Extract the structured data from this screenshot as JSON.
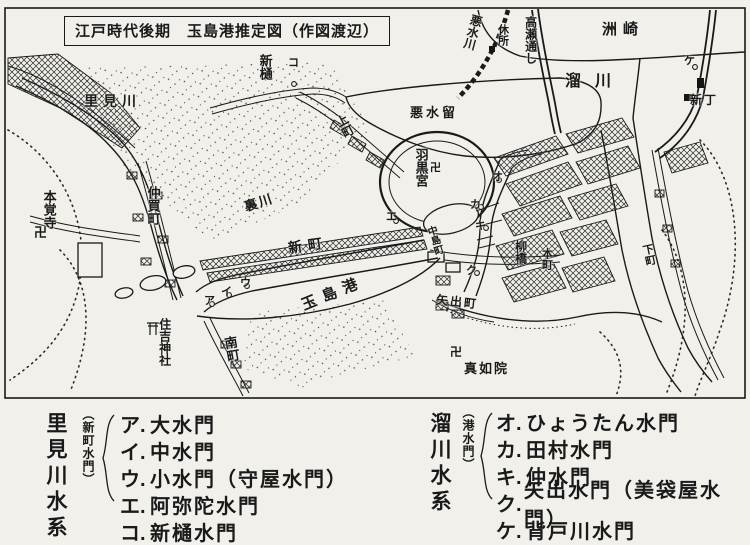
{
  "title": "江戸時代後期　玉島港推定図（作図渡辺）",
  "map": {
    "temple_symbol": "卍",
    "labels": [
      {
        "id": "suzaki",
        "text": "洲崎"
      },
      {
        "id": "tamarigawa",
        "text": "溜川"
      },
      {
        "id": "akusuigawa",
        "text": "悪水川"
      },
      {
        "id": "kyusho",
        "text": "休所"
      },
      {
        "id": "takasedoshi",
        "text": "高瀬通し"
      },
      {
        "id": "shincho",
        "text": "新丁"
      },
      {
        "id": "shinhi",
        "text": "新樋"
      },
      {
        "id": "akusuidome",
        "text": "悪水留"
      },
      {
        "id": "uwamachi",
        "text": "上町"
      },
      {
        "id": "satomigawa",
        "text": "里見川"
      },
      {
        "id": "hagurogu",
        "text": "羽黒宮"
      },
      {
        "id": "nakagaicho",
        "text": "仲買町"
      },
      {
        "id": "honkakuji",
        "text": "本覚寺"
      },
      {
        "id": "uragawa",
        "text": "裏川"
      },
      {
        "id": "shinmachi",
        "text": "新町"
      },
      {
        "id": "tamashimako",
        "text": "玉島港"
      },
      {
        "id": "sumiyoshi",
        "text": "住吉神社"
      },
      {
        "id": "minamimachi",
        "text": "南町"
      },
      {
        "id": "nakashimacho",
        "text": "中島町"
      },
      {
        "id": "yanagibashi",
        "text": "柳橋"
      },
      {
        "id": "honmachi",
        "text": "本町"
      },
      {
        "id": "yadecho",
        "text": "矢出町"
      },
      {
        "id": "shinnyoin",
        "text": "真如院"
      },
      {
        "id": "shimomachi",
        "text": "下町"
      }
    ],
    "markers": [
      {
        "key": "ア"
      },
      {
        "key": "イ"
      },
      {
        "key": "ウ"
      },
      {
        "key": "エ"
      },
      {
        "key": "オ"
      },
      {
        "key": "カ"
      },
      {
        "key": "キ"
      },
      {
        "key": "ク"
      },
      {
        "key": "ケ"
      },
      {
        "key": "コ"
      }
    ]
  },
  "legend": {
    "left": {
      "system": "里見川水系",
      "note": "（新町水門）",
      "items": [
        {
          "key": "ア.",
          "name": "大水門"
        },
        {
          "key": "イ.",
          "name": "中水門"
        },
        {
          "key": "ウ.",
          "name": "小水門（守屋水門）"
        },
        {
          "key": "エ.",
          "name": "阿弥陀水門"
        },
        {
          "key": "コ.",
          "name": "新樋水門"
        }
      ]
    },
    "right": {
      "system": "溜川水系",
      "note": "（港水門）",
      "items": [
        {
          "key": "オ.",
          "name": "ひょうたん水門"
        },
        {
          "key": "カ.",
          "name": "田村水門"
        },
        {
          "key": "キ.",
          "name": "仲水門"
        },
        {
          "key": "ク.",
          "name": "矢出水門（美袋屋水門）"
        },
        {
          "key": "ケ.",
          "name": "背戸川水門"
        }
      ]
    }
  }
}
